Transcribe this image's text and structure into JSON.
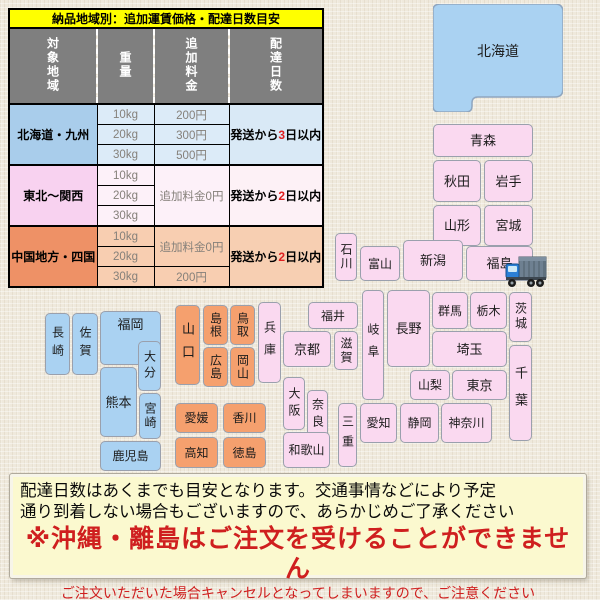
{
  "table": {
    "title": "納品地域別：追加運賃価格・配達日数目安",
    "headers": {
      "region": "対象地域",
      "weight": "重量",
      "fee": "追加料金",
      "days": "配達日数"
    },
    "regions": [
      {
        "label": "北海道・九州",
        "rows": [
          {
            "weight": "10kg",
            "fee": "200円"
          },
          {
            "weight": "20kg",
            "fee": "300円"
          },
          {
            "weight": "30kg",
            "fee": "500円"
          }
        ],
        "delivery": {
          "prefix": "発送から",
          "days": "3",
          "suffix": "日以内"
        }
      },
      {
        "label": "東北〜関西",
        "rows": [
          {
            "weight": "10kg"
          },
          {
            "weight": "20kg"
          },
          {
            "weight": "30kg"
          }
        ],
        "merged_fee": "追加料金0円",
        "delivery": {
          "prefix": "発送から",
          "days": "2",
          "suffix": "日以内"
        }
      },
      {
        "label": "中国地方・四国",
        "rows": [
          {
            "weight": "10kg"
          },
          {
            "weight": "20kg"
          },
          {
            "weight": "30kg",
            "fee": "200円"
          }
        ],
        "merged_fee": "追加料金0円",
        "delivery": {
          "prefix": "発送から",
          "days": "2",
          "suffix": "日以内"
        }
      }
    ]
  },
  "map": {
    "colors": {
      "blue": "#aad2f2",
      "pink": "#fad9f0",
      "orange": "#f5a06e"
    },
    "prefectures": [
      {
        "key": "hokkaido",
        "label": "北海道",
        "x": 433,
        "y": 4,
        "w": 130,
        "h": 108,
        "group": "blue",
        "shape": "hokkaido"
      },
      {
        "key": "aomori",
        "label": "青森",
        "x": 433,
        "y": 124,
        "w": 100,
        "h": 33,
        "group": "pink"
      },
      {
        "key": "akita",
        "label": "秋田",
        "x": 433,
        "y": 160,
        "w": 48,
        "h": 42,
        "group": "pink"
      },
      {
        "key": "iwate",
        "label": "岩手",
        "x": 484,
        "y": 160,
        "w": 49,
        "h": 42,
        "group": "pink"
      },
      {
        "key": "yamagata",
        "label": "山形",
        "x": 433,
        "y": 205,
        "w": 48,
        "h": 41,
        "group": "pink"
      },
      {
        "key": "miyagi",
        "label": "宮城",
        "x": 484,
        "y": 205,
        "w": 49,
        "h": 41,
        "group": "pink"
      },
      {
        "key": "ishikawa",
        "label": "石川",
        "x": 335,
        "y": 233,
        "w": 22,
        "h": 48,
        "group": "pink",
        "v": true,
        "fs": 12,
        "ls": 2
      },
      {
        "key": "toyama",
        "label": "富山",
        "x": 360,
        "y": 246,
        "w": 40,
        "h": 35,
        "group": "pink",
        "fs": 12
      },
      {
        "key": "niigata",
        "label": "新潟",
        "x": 403,
        "y": 240,
        "w": 60,
        "h": 41,
        "group": "pink"
      },
      {
        "key": "fukushima",
        "label": "福島",
        "x": 466,
        "y": 246,
        "w": 67,
        "h": 35,
        "group": "pink"
      },
      {
        "key": "fukui",
        "label": "福井",
        "x": 308,
        "y": 302,
        "w": 50,
        "h": 27,
        "group": "pink",
        "fs": 12
      },
      {
        "key": "hyogo",
        "label": "兵庫",
        "x": 258,
        "y": 302,
        "w": 23,
        "h": 81,
        "group": "pink",
        "v": true,
        "fs": 12,
        "ls": 10
      },
      {
        "key": "kyoto",
        "label": "京都",
        "x": 283,
        "y": 331,
        "w": 48,
        "h": 36,
        "group": "pink"
      },
      {
        "key": "shiga",
        "label": "滋賀",
        "x": 334,
        "y": 331,
        "w": 24,
        "h": 39,
        "group": "pink",
        "v": true,
        "fs": 12,
        "ls": 2
      },
      {
        "key": "gifu",
        "label": "岐阜",
        "x": 362,
        "y": 290,
        "w": 22,
        "h": 110,
        "group": "pink",
        "v": true,
        "fs": 12,
        "ls": 10
      },
      {
        "key": "nagano",
        "label": "長野",
        "x": 387,
        "y": 290,
        "w": 43,
        "h": 77,
        "group": "pink"
      },
      {
        "key": "gunma",
        "label": "群馬",
        "x": 432,
        "y": 292,
        "w": 36,
        "h": 37,
        "group": "pink",
        "fs": 12
      },
      {
        "key": "tochigi",
        "label": "栃木",
        "x": 470,
        "y": 292,
        "w": 37,
        "h": 37,
        "group": "pink",
        "fs": 12
      },
      {
        "key": "ibaraki",
        "label": "茨城",
        "x": 509,
        "y": 292,
        "w": 23,
        "h": 50,
        "group": "pink",
        "v": true,
        "fs": 12,
        "ls": 3
      },
      {
        "key": "saitama",
        "label": "埼玉",
        "x": 432,
        "y": 331,
        "w": 75,
        "h": 36,
        "group": "pink"
      },
      {
        "key": "yamanashi",
        "label": "山梨",
        "x": 410,
        "y": 370,
        "w": 40,
        "h": 30,
        "group": "pink",
        "fs": 12
      },
      {
        "key": "tokyo",
        "label": "東京",
        "x": 452,
        "y": 370,
        "w": 55,
        "h": 30,
        "group": "pink"
      },
      {
        "key": "chiba",
        "label": "千葉",
        "x": 509,
        "y": 345,
        "w": 23,
        "h": 96,
        "group": "pink",
        "v": true,
        "ls": 14
      },
      {
        "key": "osaka",
        "label": "大阪",
        "x": 283,
        "y": 377,
        "w": 22,
        "h": 53,
        "group": "pink",
        "v": true,
        "fs": 12,
        "ls": 5
      },
      {
        "key": "nara",
        "label": "奈良",
        "x": 307,
        "y": 390,
        "w": 21,
        "h": 50,
        "group": "pink",
        "v": true,
        "fs": 12,
        "ls": 5
      },
      {
        "key": "mie",
        "label": "三重",
        "x": 338,
        "y": 403,
        "w": 19,
        "h": 64,
        "group": "pink",
        "v": true,
        "fs": 12,
        "ls": 8
      },
      {
        "key": "wakayama",
        "label": "和歌山",
        "x": 283,
        "y": 432,
        "w": 47,
        "h": 36,
        "group": "pink",
        "fs": 12
      },
      {
        "key": "aichi",
        "label": "愛知",
        "x": 360,
        "y": 403,
        "w": 37,
        "h": 40,
        "group": "pink",
        "fs": 12
      },
      {
        "key": "shizuoka",
        "label": "静岡",
        "x": 400,
        "y": 403,
        "w": 39,
        "h": 40,
        "group": "pink",
        "fs": 12
      },
      {
        "key": "kanagawa",
        "label": "神奈川",
        "x": 441,
        "y": 403,
        "w": 51,
        "h": 40,
        "group": "pink",
        "fs": 12
      },
      {
        "key": "yamaguchi",
        "label": "山口",
        "x": 175,
        "y": 305,
        "w": 25,
        "h": 80,
        "group": "orange",
        "v": true,
        "ls": 10
      },
      {
        "key": "shimane",
        "label": "島根",
        "x": 203,
        "y": 305,
        "w": 25,
        "h": 40,
        "group": "orange",
        "v": true,
        "fs": 12,
        "ls": 1
      },
      {
        "key": "tottori",
        "label": "鳥取",
        "x": 230,
        "y": 305,
        "w": 25,
        "h": 40,
        "group": "orange",
        "v": true,
        "fs": 12,
        "ls": 1
      },
      {
        "key": "hiroshima",
        "label": "広島",
        "x": 203,
        "y": 347,
        "w": 25,
        "h": 40,
        "group": "orange",
        "v": true,
        "fs": 12,
        "ls": 1
      },
      {
        "key": "okayama",
        "label": "岡山",
        "x": 230,
        "y": 347,
        "w": 25,
        "h": 40,
        "group": "orange",
        "v": true,
        "fs": 12,
        "ls": 1
      },
      {
        "key": "ehime",
        "label": "愛媛",
        "x": 175,
        "y": 403,
        "w": 43,
        "h": 30,
        "group": "orange",
        "fs": 12
      },
      {
        "key": "kagawa",
        "label": "香川",
        "x": 223,
        "y": 403,
        "w": 43,
        "h": 30,
        "group": "orange",
        "fs": 12
      },
      {
        "key": "kochi",
        "label": "高知",
        "x": 175,
        "y": 437,
        "w": 43,
        "h": 31,
        "group": "orange",
        "fs": 12
      },
      {
        "key": "tokushima",
        "label": "徳島",
        "x": 223,
        "y": 437,
        "w": 43,
        "h": 31,
        "group": "orange",
        "fs": 12
      },
      {
        "key": "nagasaki",
        "label": "長崎",
        "x": 45,
        "y": 313,
        "w": 25,
        "h": 62,
        "group": "blue",
        "v": true,
        "fs": 12,
        "ls": 6
      },
      {
        "key": "saga",
        "label": "佐賀",
        "x": 72,
        "y": 313,
        "w": 26,
        "h": 62,
        "group": "blue",
        "v": true,
        "fs": 12,
        "ls": 6
      },
      {
        "key": "fukuoka",
        "label": "福岡",
        "x": 100,
        "y": 311,
        "w": 61,
        "h": 54,
        "group": "blue",
        "lt": true
      },
      {
        "key": "oita",
        "label": "大分",
        "x": 138,
        "y": 341,
        "w": 23,
        "h": 50,
        "group": "blue",
        "v": true,
        "fs": 12,
        "ls": 4
      },
      {
        "key": "kumamoto",
        "label": "熊本",
        "x": 100,
        "y": 367,
        "w": 37,
        "h": 70,
        "group": "blue"
      },
      {
        "key": "miyazaki",
        "label": "宮崎",
        "x": 139,
        "y": 393,
        "w": 22,
        "h": 46,
        "group": "blue",
        "v": true,
        "fs": 12,
        "ls": 2
      },
      {
        "key": "kagoshima",
        "label": "鹿児島",
        "x": 100,
        "y": 441,
        "w": 61,
        "h": 30,
        "group": "blue",
        "fs": 12
      }
    ]
  },
  "icons": {
    "truck": "delivery-truck-icon"
  },
  "notice": {
    "line1": "配達日数はあくまでも目安となります。交通事情などにより予定",
    "line2": "通り到着しない場合もございますので、あらかじめご了承ください",
    "warning": "※沖縄・離島はご注文を受けることができません",
    "sub_warning": "ご注文いただいた場合キャンセルとなってしまいますので、ご注意ください"
  },
  "colors": {
    "title_bg": "#ffff00",
    "header_bg": "#7f7f7f",
    "warning_red": "#cf1f1f",
    "days_red": "#e02020",
    "region_blue": "#aad2f2",
    "region_pink": "#fad9f0",
    "region_orange": "#f5a06e"
  }
}
